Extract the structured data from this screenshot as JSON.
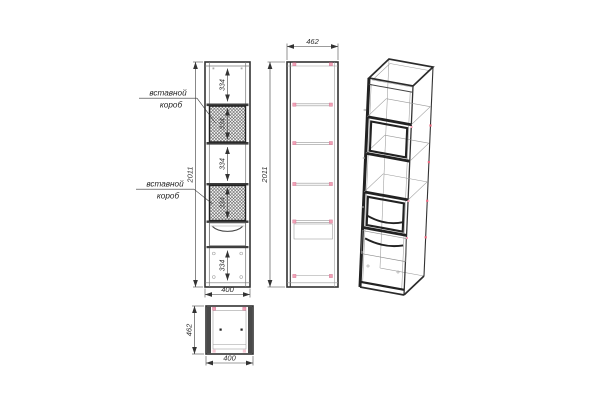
{
  "drawing": {
    "callouts": {
      "insert_box_top": {
        "line_1": "вставной",
        "line_2": "короб"
      },
      "insert_box_bottom": {
        "line_1": "вставной",
        "line_2": "короб"
      }
    },
    "dimensions": {
      "front_overall_height": "2011",
      "front_width": "400",
      "front_section_top": "334",
      "front_insert_box_top": "334",
      "front_section_middle": "334",
      "front_insert_box_bottom": "334",
      "front_section_bottom": "334",
      "side_depth": "462",
      "side_overall_height": "2011",
      "plan_depth": "462",
      "plan_width": "400"
    },
    "colors": {
      "line": "#333333",
      "hatch": "#4a4a4a",
      "fitting_marker_pink": "#f2a0b6",
      "fitting_marker_red": "#e9687f",
      "background": "#ffffff"
    }
  }
}
